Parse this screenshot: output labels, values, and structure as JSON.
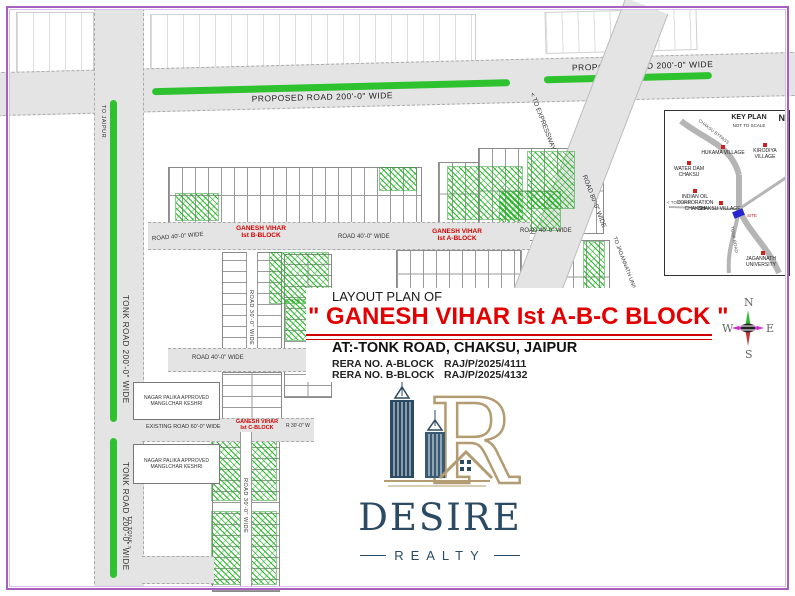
{
  "title_block": {
    "line1": "LAYOUT PLAN OF",
    "main": "\" GANESH VIHAR Ist A-B-C BLOCK \"",
    "address": "AT:-TONK ROAD, CHAKSU, JAIPUR",
    "rera": [
      {
        "label": "RERA NO. A-BLOCK",
        "value": "RAJ/P/2025/4111"
      },
      {
        "label": "RERA NO. B-BLOCK",
        "value": "RAJ/P/2025/4132"
      }
    ]
  },
  "roads": {
    "proposed": "PROPOSED ROAD 200'-0\" WIDE",
    "tonk": "TONK ROAD 200'-0\" WIDE",
    "existing": "EXISTING ROAD 60'-0\" WIDE",
    "road80": "ROAD 80'-0\" WIDE",
    "road40": "ROAD 40'-0\" WIDE",
    "road30": "ROAD 30'-0\" WIDE",
    "r30w": "R 30'-0\" W",
    "to_jaipur": "TO JAIPUR",
    "to_tonk": "TO TONK >",
    "to_expressway": "< TO EXPRESSWAY",
    "to_university": "TO JAGANNATH UNIVERSITY >"
  },
  "blocks": {
    "name": "GANESH VIHAR",
    "a": "Ist A-BLOCK",
    "b": "Ist B-BLOCK",
    "c": "Ist C-BLOCK"
  },
  "notes": {
    "approved1": "NAGAR PALIKA APPROVED",
    "approved2": "MANGLCHAR KESHRI"
  },
  "keyplan": {
    "title": "KEY PLAN",
    "subtitle": "NOT TO SCALE",
    "north": "N",
    "places": [
      {
        "label": "HUKAMA VILLAGE"
      },
      {
        "label": "KIRODIYA VILLAGE"
      },
      {
        "label": "WATER DAM CHAKSU"
      },
      {
        "label": "INDIAN OIL CORPORATION CHAKSU"
      },
      {
        "label": "CHAKSU VILLAGE"
      },
      {
        "label": "JAGANNATH UNIVERSITY"
      }
    ],
    "to_phagi": "< TO PHAGI",
    "site": "SITE",
    "road1": "CHAKSU BYPASS",
    "road2": "TONK ROAD"
  },
  "compass": {
    "n": "N",
    "s": "S",
    "e": "E",
    "w": "W"
  },
  "logo": {
    "name": "DESIRE",
    "tagline": "REALTY"
  }
}
